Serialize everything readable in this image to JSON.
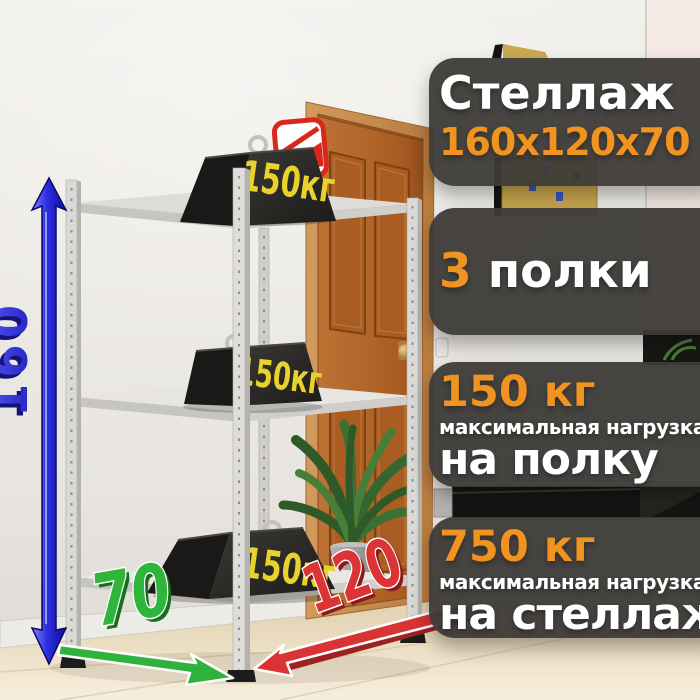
{
  "panels": {
    "title": {
      "heading": "Стеллаж",
      "dimensions": "160х120х70"
    },
    "shelves": {
      "count": "3",
      "label": "полки"
    },
    "shelf_load": {
      "value": "150 кг",
      "caption": "максимальная нагрузка",
      "target": "на полку"
    },
    "rack_load": {
      "value": "750 кг",
      "caption": "максимальная нагрузка",
      "target": "на стеллаж"
    }
  },
  "scene": {
    "weight_label": "150кг",
    "height_label": "160",
    "depth_label": "70",
    "width_label": "120"
  },
  "colors": {
    "accent_orange": "#F09320",
    "panel_background": "rgba(61,59,56,0.95)",
    "height_arrow_blue": "#2222C8",
    "depth_arrow_green": "#2FB23C",
    "width_arrow_red": "#D93333",
    "weight_text_yellow": "#E8D22B"
  },
  "icons": {
    "top_weight_badge": "red-package-icon"
  }
}
